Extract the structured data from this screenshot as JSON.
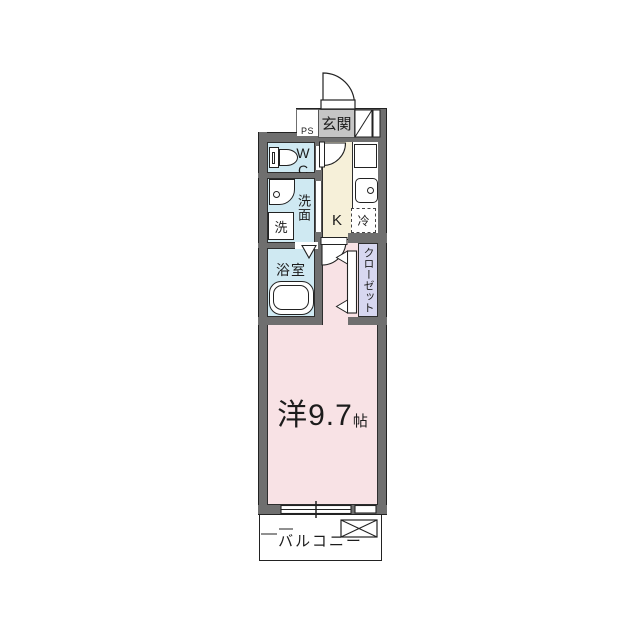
{
  "labels": {
    "entrance": "玄関",
    "pipe_space": "PS",
    "toilet": "WC",
    "washroom": "洗面",
    "washing_machine": "洗",
    "kitchen": "K",
    "refrigerator": "冷",
    "bathroom": "浴室",
    "closet": "クローゼット",
    "main_room_name": "洋9.7",
    "main_room_unit": "帖",
    "balcony": "バルコニー"
  },
  "colors": {
    "wall_gray": "#6f6f6f",
    "entrance_label_bg": "#c6c6c6",
    "wet_room_blue": "#cfe9f2",
    "kitchen_cream": "#f6f0d9",
    "main_room_pink": "#f8e2e5",
    "closet_lavender": "#d7d7f0",
    "line_black": "#222222"
  }
}
